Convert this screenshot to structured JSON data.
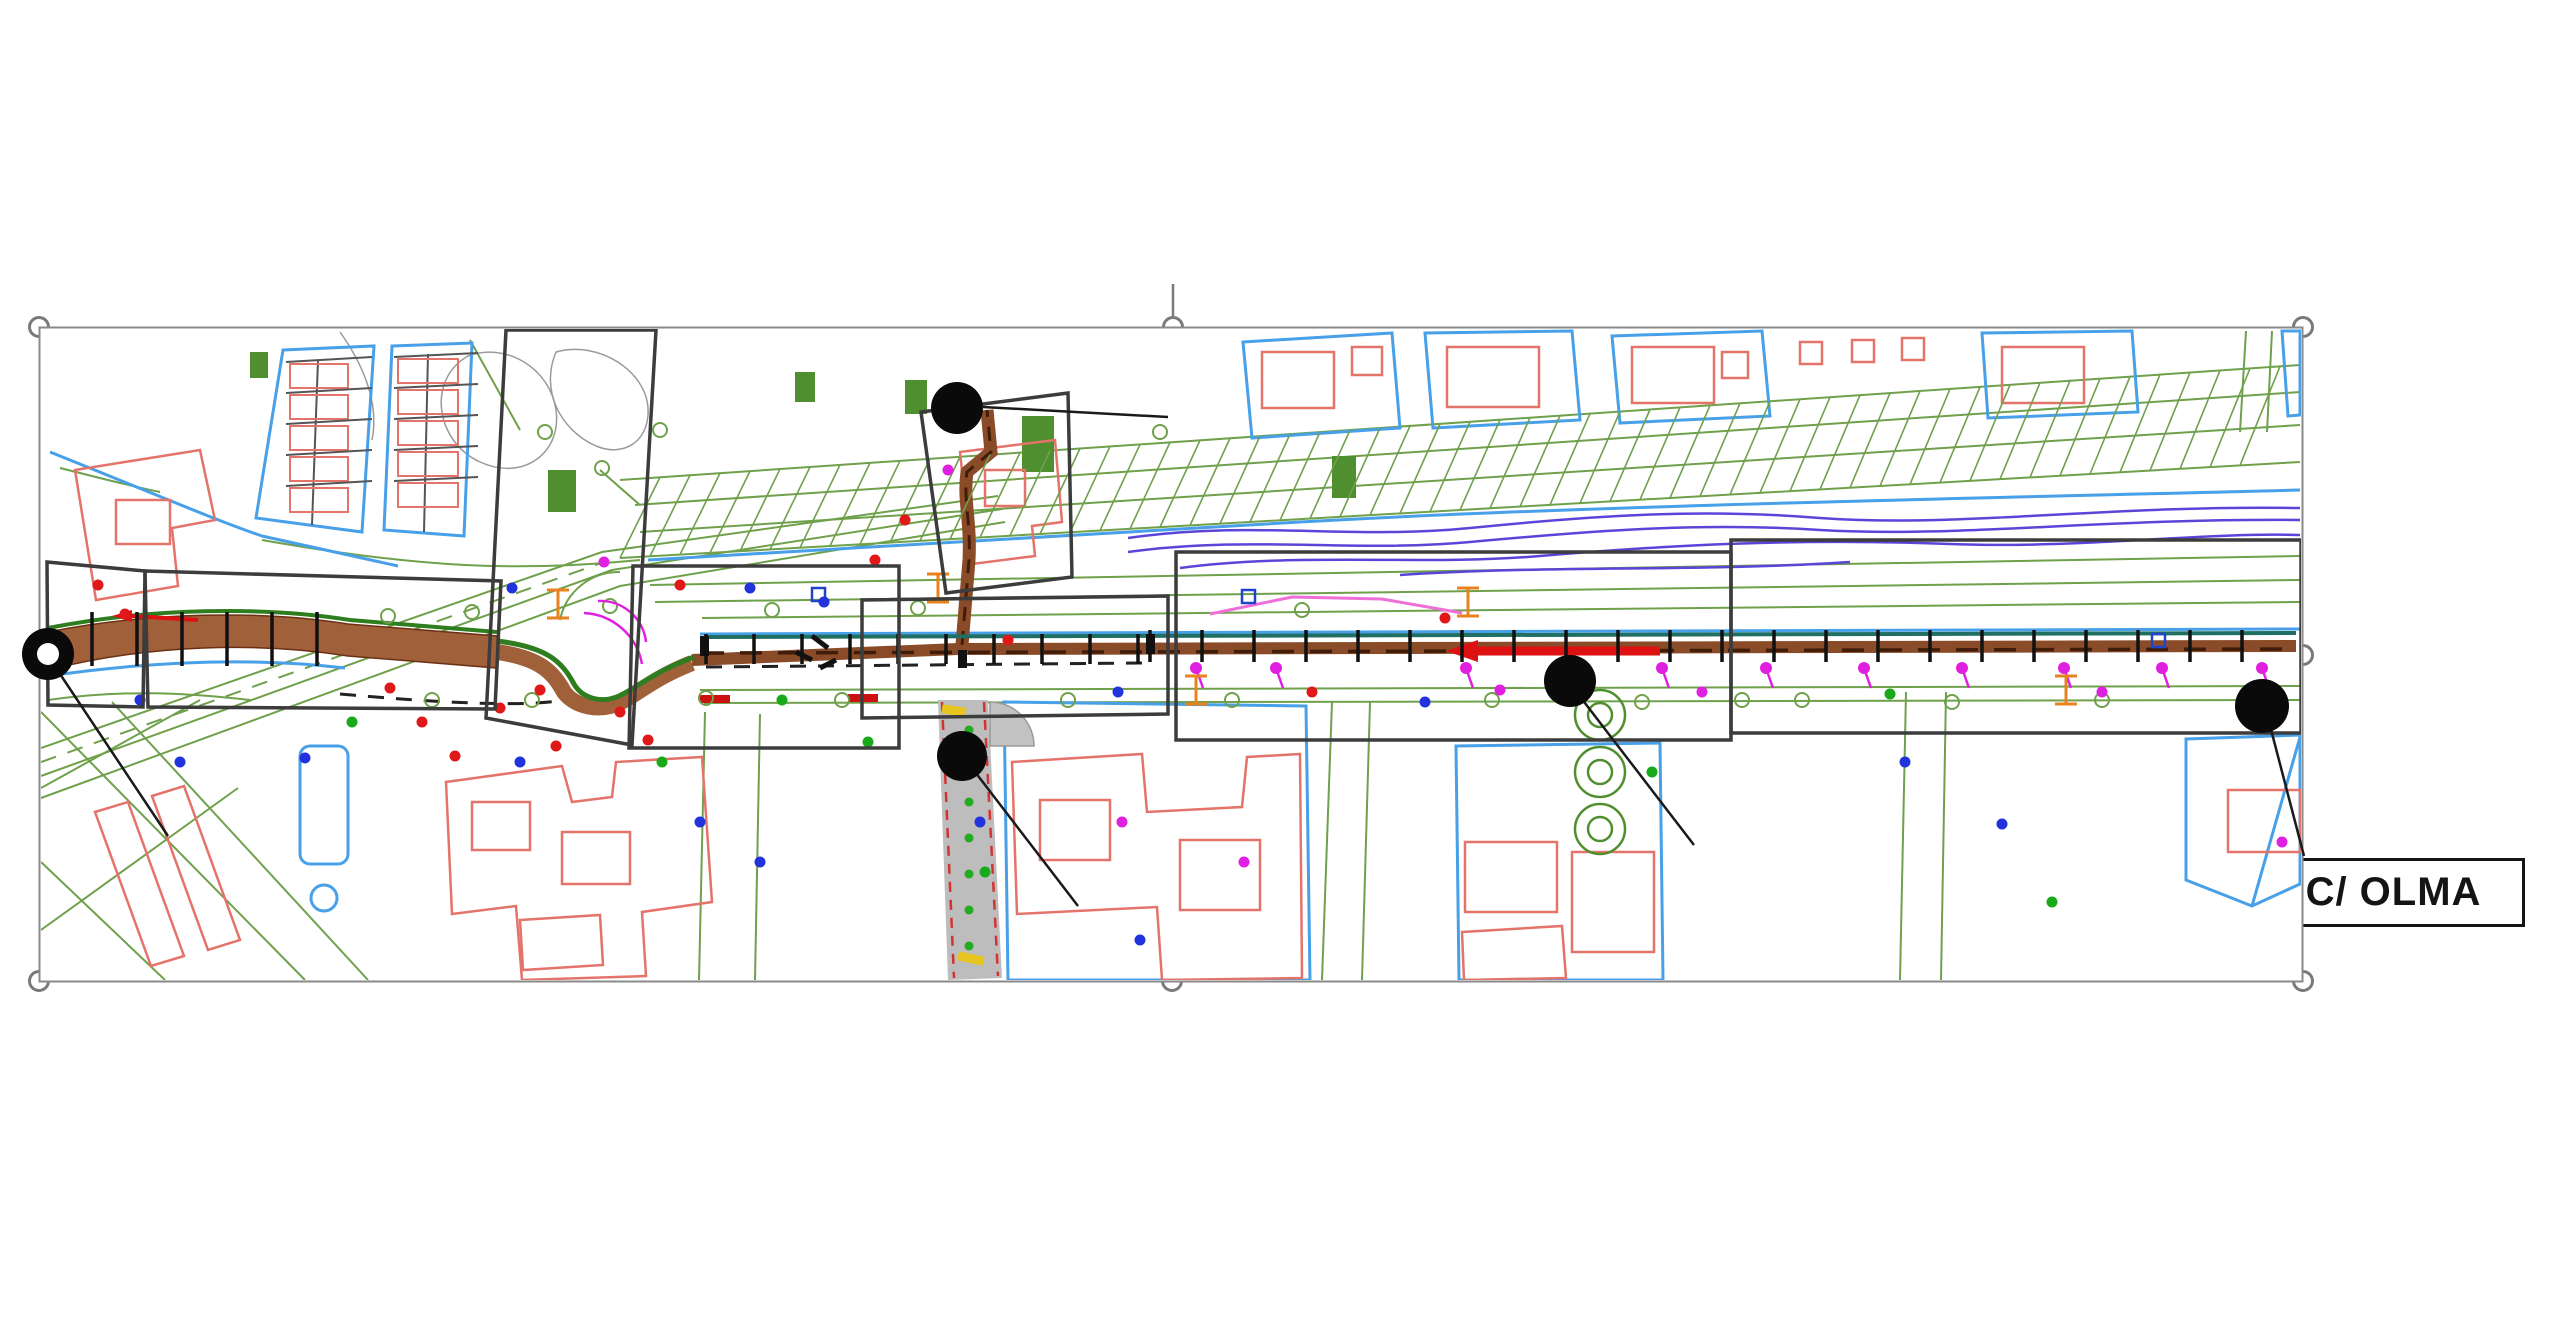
{
  "slide": {
    "width": 2560,
    "height": 1344,
    "background": "#ffffff"
  },
  "map_frame": {
    "x": 39,
    "y": 327,
    "width": 2264,
    "height": 655,
    "border_color": "#8a8a8a"
  },
  "rotation_stem": {
    "x": 1173,
    "y1": 284,
    "y2": 317
  },
  "selection_handles": [
    {
      "id": "top-left",
      "x": 39,
      "y": 327
    },
    {
      "id": "top-center",
      "x": 1173,
      "y": 327
    },
    {
      "id": "top-right",
      "x": 2303,
      "y": 327
    },
    {
      "id": "middle-left",
      "x": 39,
      "y": 654
    },
    {
      "id": "middle-right",
      "x": 2303,
      "y": 655
    },
    {
      "id": "bottom-left",
      "x": 39,
      "y": 981
    },
    {
      "id": "bottom-center",
      "x": 1172,
      "y": 981
    },
    {
      "id": "bottom-right",
      "x": 2303,
      "y": 981
    }
  ],
  "street_labels": [
    {
      "id": "canal",
      "text": "C/ CANAL",
      "box": {
        "x": 1168,
        "y": 385,
        "w": 260,
        "h": 68
      },
      "dot": {
        "x": 957,
        "y": 408,
        "r": 26,
        "style": "solid"
      },
      "leader": {
        "x1": 983,
        "y1": 407,
        "x2": 1168,
        "y2": 417
      }
    },
    {
      "id": "gijon",
      "text": "AVDA GIJÓN",
      "box": {
        "x": 170,
        "y": 834,
        "w": 308,
        "h": 71
      },
      "dot": {
        "x": 48,
        "y": 654,
        "r": 26,
        "style": "donut"
      },
      "leader": {
        "x1": 56,
        "y1": 668,
        "x2": 168,
        "y2": 836
      }
    },
    {
      "id": "mieses",
      "text": "C/ MIESES",
      "box": {
        "x": 1080,
        "y": 875,
        "w": 245,
        "h": 70
      },
      "dot": {
        "x": 962,
        "y": 756,
        "r": 25,
        "style": "solid"
      },
      "leader": {
        "x1": 972,
        "y1": 768,
        "x2": 1078,
        "y2": 906
      }
    },
    {
      "id": "eras",
      "text": "C/ ERAS",
      "box": {
        "x": 1698,
        "y": 810,
        "w": 263,
        "h": 74
      },
      "dot": {
        "x": 1570,
        "y": 681,
        "r": 26,
        "style": "solid"
      },
      "leader": {
        "x1": 1578,
        "y1": 694,
        "x2": 1694,
        "y2": 845
      }
    },
    {
      "id": "olma",
      "text": "C/ OLMA",
      "box": {
        "x": 2262,
        "y": 858,
        "w": 263,
        "h": 69
      },
      "dot": {
        "x": 2262,
        "y": 706,
        "r": 27,
        "style": "solid"
      },
      "leader": {
        "x1": 2268,
        "y1": 718,
        "x2": 2304,
        "y2": 856
      }
    }
  ],
  "zone_markers": [
    {
      "label": "1",
      "x": 1789,
      "y": 579,
      "r": 29
    },
    {
      "label": "2",
      "x": 1224,
      "y": 583,
      "r": 28
    },
    {
      "label": "3",
      "x": 1113,
      "y": 667,
      "r": 30
    },
    {
      "label": "4",
      "x": 903,
      "y": 453,
      "r": 27
    },
    {
      "label": "4b",
      "x": 1028,
      "y": 402,
      "r": 27
    },
    {
      "label": "5",
      "x": 670,
      "y": 595,
      "r": 28
    },
    {
      "label": "6",
      "x": 546,
      "y": 372,
      "r": 30
    },
    {
      "label": "7",
      "x": 195,
      "y": 608,
      "r": 30
    }
  ],
  "palette": {
    "green_lines": "#6fa04b",
    "green_fill": "#4f8f2f",
    "blue_parcels": "#47a0e8",
    "red_buildings": "#e4736a",
    "river_purple": "#5b45d8",
    "pipeline_brown": "#9c5d38",
    "pipeline_dark": "#3f1d0a",
    "road_green_edge": "#2e7d1e",
    "zone_box": "#3c3c3c",
    "marker_black": "#0a0a0a",
    "accent_red": "#dd1111",
    "accent_magenta": "#e020e0",
    "accent_orange": "#e8821e",
    "street_gray": "#bdbdbd"
  }
}
